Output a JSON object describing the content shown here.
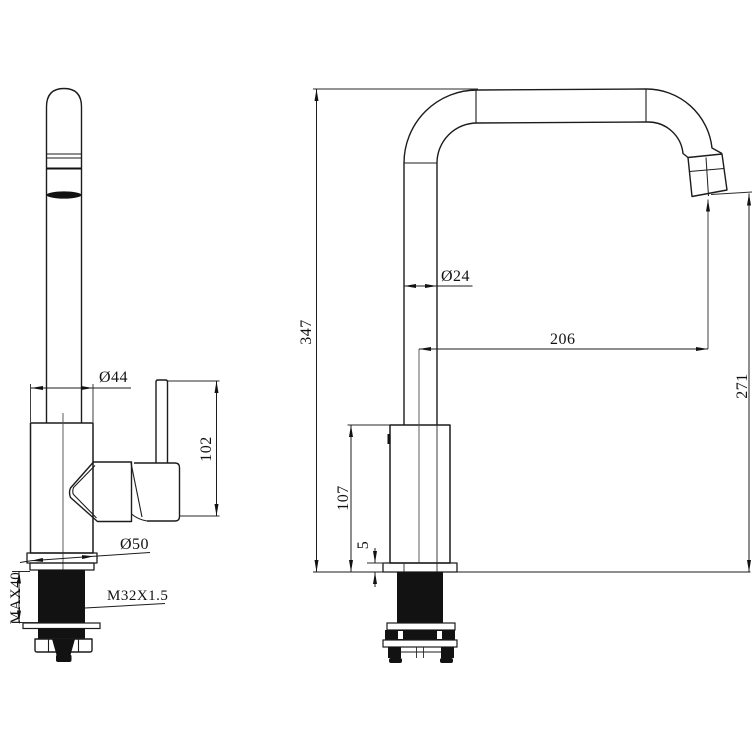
{
  "front_view": {
    "dimensions": {
      "body_diameter": "Ø44",
      "handle_height": "102",
      "base_diameter": "Ø50",
      "thread_length": "MAX40",
      "thread_spec": "M32X1.5"
    }
  },
  "side_view": {
    "dimensions": {
      "overall_height": "347",
      "pipe_diameter": "Ø24",
      "spout_reach": "206",
      "outlet_height": "271",
      "body_height": "107",
      "base_plate_thickness": "5"
    }
  }
}
